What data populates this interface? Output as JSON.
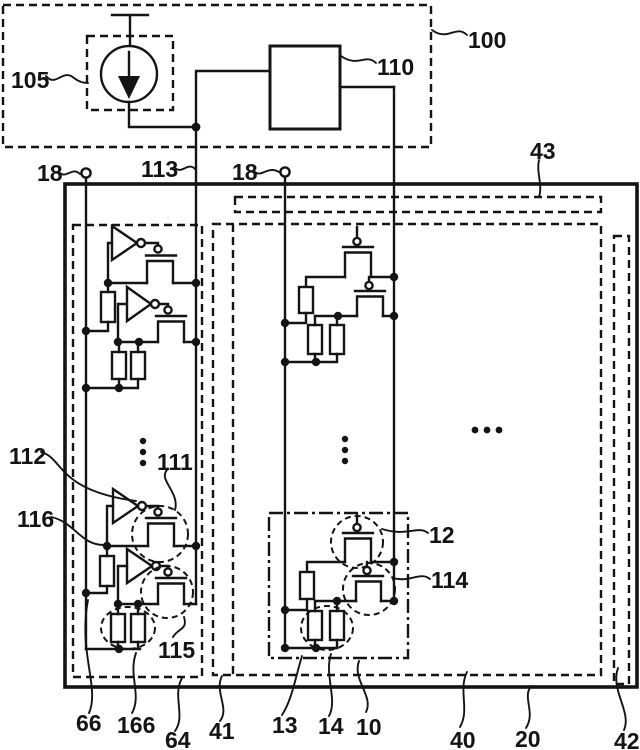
{
  "figure": {
    "type": "patent-circuit-diagram",
    "colors": {
      "ink": "#141414",
      "background": "#ffffff"
    },
    "labels": {
      "ref_100": "100",
      "ref_105": "105",
      "ref_110": "110",
      "ref_113": "113",
      "ref_18_left": "18",
      "ref_18_right": "18",
      "ref_43": "43",
      "ref_112": "112",
      "ref_111": "111",
      "ref_116": "116",
      "ref_12": "12",
      "ref_114": "114",
      "ref_115": "115",
      "ref_66": "66",
      "ref_166": "166",
      "ref_64": "64",
      "ref_41": "41",
      "ref_13": "13",
      "ref_14": "14",
      "ref_10": "10",
      "ref_40": "40",
      "ref_20": "20",
      "ref_42": "42"
    }
  }
}
